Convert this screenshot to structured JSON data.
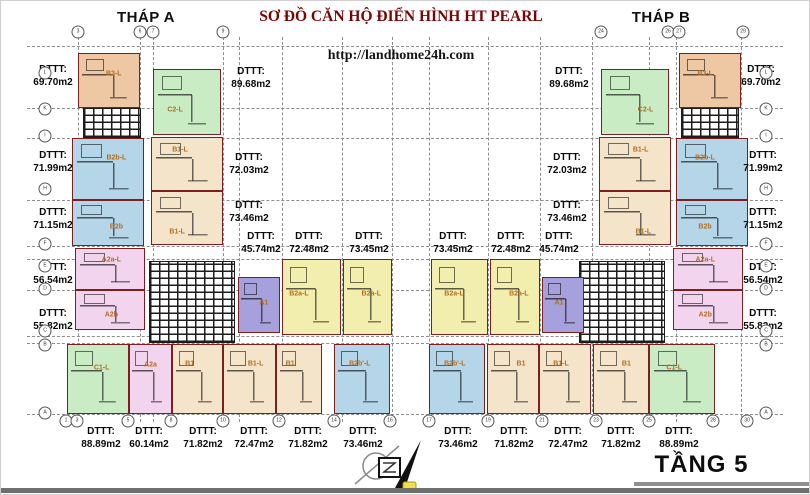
{
  "header": {
    "tower_a": "THÁP A",
    "title": "SƠ ĐỒ CĂN HỘ ĐIỂN HÌNH HT PEARL",
    "url": "http://landhome24h.com",
    "tower_b": "THÁP B"
  },
  "footer": {
    "floor_label": "TẦNG 5"
  },
  "colors": {
    "orange": "#edc8a3",
    "green": "#c9ecc5",
    "blue": "#b5d5e9",
    "pink": "#f2d4ee",
    "yellow": "#f2efae",
    "purple": "#a6a0dc",
    "cream": "#f4e4ca",
    "unit_border": "#7e1f1f",
    "unit_label_text": "#b36d1f",
    "title_text": "#7a0505"
  },
  "plan": {
    "area_prefix": "DTTT:",
    "units": [
      {
        "label": "B3-L",
        "color": "orange",
        "x": 77,
        "y": 52,
        "w": 62,
        "h": 55,
        "lx": 58,
        "ly": 38
      },
      {
        "label": "B2b-L",
        "color": "blue",
        "x": 71,
        "y": 137,
        "w": 72,
        "h": 62,
        "lx": 62,
        "ly": 32
      },
      {
        "label": "B2b",
        "color": "blue",
        "x": 71,
        "y": 199,
        "w": 72,
        "h": 46,
        "lx": 62,
        "ly": 58
      },
      {
        "label": "A2a-L",
        "color": "pink",
        "x": 74,
        "y": 247,
        "w": 70,
        "h": 42,
        "lx": 52,
        "ly": 28
      },
      {
        "label": "A2b",
        "color": "pink",
        "x": 74,
        "y": 289,
        "w": 70,
        "h": 40,
        "lx": 52,
        "ly": 62
      },
      {
        "label": "C2-L",
        "color": "green",
        "x": 152,
        "y": 68,
        "w": 68,
        "h": 66,
        "lx": 32,
        "ly": 62
      },
      {
        "label": "B1-L",
        "color": "cream",
        "x": 150,
        "y": 136,
        "w": 72,
        "h": 54,
        "lx": 40,
        "ly": 24
      },
      {
        "label": "B1-L",
        "color": "cream",
        "x": 150,
        "y": 190,
        "w": 72,
        "h": 54,
        "lx": 36,
        "ly": 76
      },
      {
        "label": "A1",
        "color": "purple",
        "x": 237,
        "y": 276,
        "w": 42,
        "h": 56,
        "lx": 62,
        "ly": 46
      },
      {
        "label": "B2a-L",
        "color": "yellow",
        "x": 281,
        "y": 258,
        "w": 59,
        "h": 76,
        "lx": 28,
        "ly": 46
      },
      {
        "label": "B2a-L",
        "color": "yellow",
        "x": 342,
        "y": 258,
        "w": 49,
        "h": 76,
        "lx": 58,
        "ly": 46
      },
      {
        "label": "C1-L",
        "color": "green",
        "x": 66,
        "y": 343,
        "w": 62,
        "h": 70,
        "lx": 56,
        "ly": 34
      },
      {
        "label": "A2a",
        "color": "pink",
        "x": 128,
        "y": 343,
        "w": 43,
        "h": 70,
        "lx": 50,
        "ly": 30
      },
      {
        "label": "B1",
        "color": "cream",
        "x": 171,
        "y": 343,
        "w": 51,
        "h": 70,
        "lx": 34,
        "ly": 28
      },
      {
        "label": "B1-L",
        "color": "cream",
        "x": 222,
        "y": 343,
        "w": 53,
        "h": 70,
        "lx": 62,
        "ly": 28
      },
      {
        "label": "B1",
        "color": "cream",
        "x": 275,
        "y": 343,
        "w": 46,
        "h": 70,
        "lx": 30,
        "ly": 28
      },
      {
        "label": "B2b'-L",
        "color": "blue",
        "x": 333,
        "y": 343,
        "w": 56,
        "h": 70,
        "lx": 46,
        "ly": 28
      },
      {
        "label": "B2b'-L",
        "color": "blue",
        "x": 428,
        "y": 343,
        "w": 56,
        "h": 70,
        "lx": 46,
        "ly": 28
      },
      {
        "label": "B1",
        "color": "cream",
        "x": 486,
        "y": 343,
        "w": 52,
        "h": 70,
        "lx": 66,
        "ly": 28
      },
      {
        "label": "B1-L",
        "color": "cream",
        "x": 538,
        "y": 343,
        "w": 52,
        "h": 70,
        "lx": 42,
        "ly": 28
      },
      {
        "label": "B1",
        "color": "cream",
        "x": 592,
        "y": 343,
        "w": 56,
        "h": 70,
        "lx": 60,
        "ly": 28
      },
      {
        "label": "C1-L",
        "color": "green",
        "x": 648,
        "y": 343,
        "w": 66,
        "h": 70,
        "lx": 38,
        "ly": 34
      },
      {
        "label": "B2a-L",
        "color": "yellow",
        "x": 430,
        "y": 258,
        "w": 57,
        "h": 76,
        "lx": 40,
        "ly": 46
      },
      {
        "label": "B2a-L",
        "color": "yellow",
        "x": 489,
        "y": 258,
        "w": 50,
        "h": 76,
        "lx": 58,
        "ly": 46
      },
      {
        "label": "A1",
        "color": "purple",
        "x": 541,
        "y": 276,
        "w": 42,
        "h": 56,
        "lx": 40,
        "ly": 46
      },
      {
        "label": "C2-L",
        "color": "green",
        "x": 600,
        "y": 68,
        "w": 68,
        "h": 66,
        "lx": 66,
        "ly": 62
      },
      {
        "label": "B1-L",
        "color": "cream",
        "x": 598,
        "y": 136,
        "w": 72,
        "h": 54,
        "lx": 58,
        "ly": 24
      },
      {
        "label": "B1-L",
        "color": "cream",
        "x": 598,
        "y": 190,
        "w": 72,
        "h": 54,
        "lx": 62,
        "ly": 76
      },
      {
        "label": "B3-L",
        "color": "orange",
        "x": 678,
        "y": 52,
        "w": 62,
        "h": 55,
        "lx": 42,
        "ly": 38
      },
      {
        "label": "B2b-L",
        "color": "blue",
        "x": 675,
        "y": 137,
        "w": 72,
        "h": 62,
        "lx": 40,
        "ly": 32
      },
      {
        "label": "B2b",
        "color": "blue",
        "x": 675,
        "y": 199,
        "w": 72,
        "h": 46,
        "lx": 40,
        "ly": 58
      },
      {
        "label": "A2a-L",
        "color": "pink",
        "x": 672,
        "y": 247,
        "w": 70,
        "h": 42,
        "lx": 46,
        "ly": 28
      },
      {
        "label": "A2b",
        "color": "pink",
        "x": 672,
        "y": 289,
        "w": 70,
        "h": 40,
        "lx": 46,
        "ly": 62
      }
    ],
    "cores": [
      {
        "x": 82,
        "y": 107,
        "w": 58,
        "h": 30
      },
      {
        "x": 680,
        "y": 107,
        "w": 58,
        "h": 30
      },
      {
        "x": 148,
        "y": 260,
        "w": 86,
        "h": 82
      },
      {
        "x": 578,
        "y": 260,
        "w": 86,
        "h": 82
      }
    ],
    "area_labels": [
      {
        "v": "69.70m2",
        "x": 52,
        "y": 62
      },
      {
        "v": "71.99m2",
        "x": 52,
        "y": 148
      },
      {
        "v": "71.15m2",
        "x": 52,
        "y": 205
      },
      {
        "v": "56.54m2",
        "x": 52,
        "y": 260
      },
      {
        "v": "55.82m2",
        "x": 52,
        "y": 306
      },
      {
        "v": "89.68m2",
        "x": 250,
        "y": 64
      },
      {
        "v": "72.03m2",
        "x": 248,
        "y": 150
      },
      {
        "v": "73.46m2",
        "x": 248,
        "y": 198
      },
      {
        "v": "45.74m2",
        "x": 260,
        "y": 229
      },
      {
        "v": "72.48m2",
        "x": 308,
        "y": 229
      },
      {
        "v": "73.45m2",
        "x": 368,
        "y": 229
      },
      {
        "v": "73.45m2",
        "x": 452,
        "y": 229
      },
      {
        "v": "72.48m2",
        "x": 510,
        "y": 229
      },
      {
        "v": "45.74m2",
        "x": 558,
        "y": 229
      },
      {
        "v": "89.68m2",
        "x": 568,
        "y": 64
      },
      {
        "v": "72.03m2",
        "x": 566,
        "y": 150
      },
      {
        "v": "73.46m2",
        "x": 566,
        "y": 198
      },
      {
        "v": "69.70m2",
        "x": 760,
        "y": 62
      },
      {
        "v": "71.99m2",
        "x": 762,
        "y": 148
      },
      {
        "v": "71.15m2",
        "x": 762,
        "y": 205
      },
      {
        "v": "56.54m2",
        "x": 762,
        "y": 260
      },
      {
        "v": "55.82m2",
        "x": 762,
        "y": 306
      },
      {
        "v": "88.89m2",
        "x": 100,
        "y": 424
      },
      {
        "v": "60.14m2",
        "x": 148,
        "y": 424
      },
      {
        "v": "71.82m2",
        "x": 202,
        "y": 424
      },
      {
        "v": "72.47m2",
        "x": 253,
        "y": 424
      },
      {
        "v": "71.82m2",
        "x": 307,
        "y": 424
      },
      {
        "v": "73.46m2",
        "x": 362,
        "y": 424
      },
      {
        "v": "73.46m2",
        "x": 457,
        "y": 424
      },
      {
        "v": "71.82m2",
        "x": 513,
        "y": 424
      },
      {
        "v": "72.47m2",
        "x": 567,
        "y": 424
      },
      {
        "v": "71.82m2",
        "x": 620,
        "y": 424
      },
      {
        "v": "88.89m2",
        "x": 678,
        "y": 424
      }
    ],
    "grid_h": [
      45,
      107,
      137,
      199,
      245,
      258,
      289,
      335,
      342,
      413
    ],
    "grid_v": [
      77,
      139,
      152,
      222,
      238,
      281,
      341,
      391,
      428,
      487,
      539,
      591,
      648,
      675,
      740
    ],
    "bubbles_top": [
      {
        "x": 77,
        "n": "3"
      },
      {
        "x": 139,
        "n": "6"
      },
      {
        "x": 152,
        "n": "7"
      },
      {
        "x": 222,
        "n": "9"
      },
      {
        "x": 600,
        "n": "24"
      },
      {
        "x": 667,
        "n": "26"
      },
      {
        "x": 678,
        "n": "27"
      },
      {
        "x": 742,
        "n": "29"
      }
    ],
    "bubbles_bottom": [
      {
        "x": 65,
        "n": "1"
      },
      {
        "x": 76,
        "n": "3"
      },
      {
        "x": 127,
        "n": "5"
      },
      {
        "x": 170,
        "n": "8"
      },
      {
        "x": 222,
        "n": "10"
      },
      {
        "x": 278,
        "n": "12"
      },
      {
        "x": 333,
        "n": "14"
      },
      {
        "x": 389,
        "n": "16"
      },
      {
        "x": 428,
        "n": "17"
      },
      {
        "x": 487,
        "n": "19"
      },
      {
        "x": 541,
        "n": "21"
      },
      {
        "x": 595,
        "n": "23"
      },
      {
        "x": 648,
        "n": "25"
      },
      {
        "x": 712,
        "n": "28"
      },
      {
        "x": 746,
        "n": "30"
      }
    ],
    "bubbles_left": [
      {
        "y": 72,
        "n": "L"
      },
      {
        "y": 108,
        "n": "K"
      },
      {
        "y": 135,
        "n": "I"
      },
      {
        "y": 188,
        "n": "H"
      },
      {
        "y": 243,
        "n": "F"
      },
      {
        "y": 265,
        "n": "E"
      },
      {
        "y": 288,
        "n": "D"
      },
      {
        "y": 330,
        "n": "C"
      },
      {
        "y": 344,
        "n": "B"
      },
      {
        "y": 412,
        "n": "A"
      }
    ],
    "bubbles_right": [
      {
        "y": 72,
        "n": "L"
      },
      {
        "y": 108,
        "n": "K"
      },
      {
        "y": 135,
        "n": "I"
      },
      {
        "y": 188,
        "n": "H"
      },
      {
        "y": 243,
        "n": "F"
      },
      {
        "y": 265,
        "n": "E"
      },
      {
        "y": 288,
        "n": "D"
      },
      {
        "y": 330,
        "n": "C"
      },
      {
        "y": 344,
        "n": "B"
      },
      {
        "y": 412,
        "n": "A"
      }
    ]
  }
}
